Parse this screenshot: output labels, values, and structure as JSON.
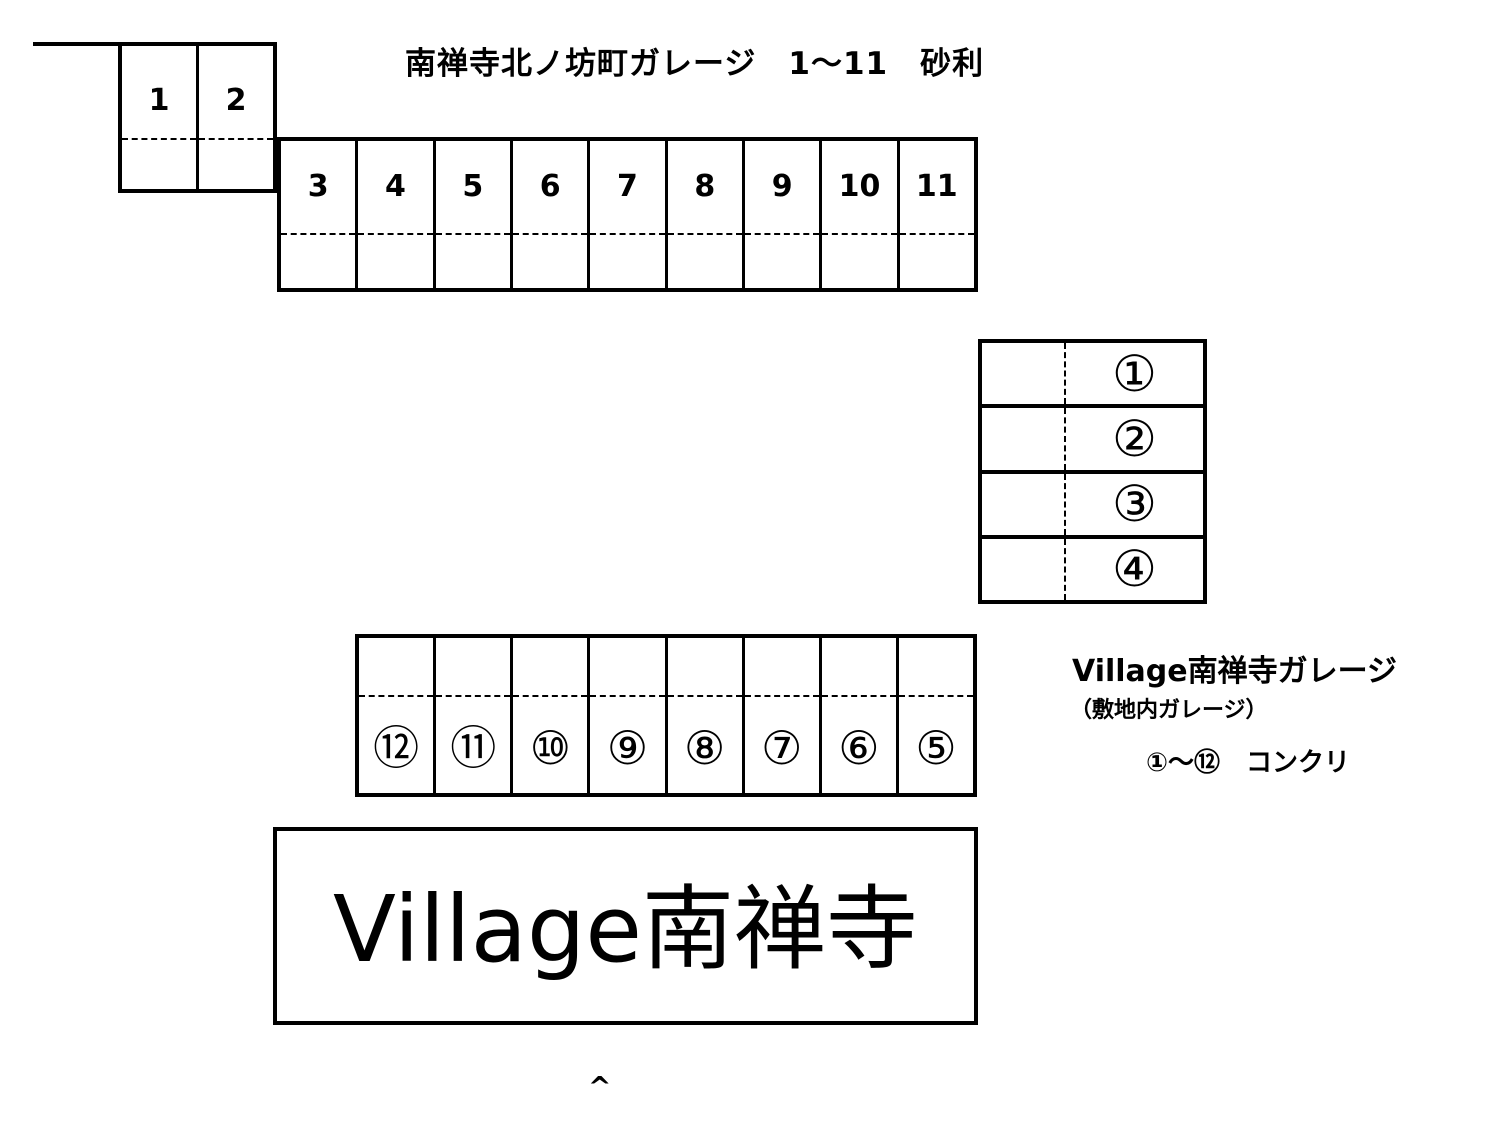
{
  "north_lot": {
    "title": "南禅寺北ノ坊町ガレージ　1～11　砂利",
    "upper_cells": [
      "1",
      "2"
    ],
    "lower_cells": [
      "3",
      "4",
      "5",
      "6",
      "7",
      "8",
      "9",
      "10",
      "11"
    ]
  },
  "village_lot": {
    "side_table_rows": [
      "①",
      "②",
      "③",
      "④"
    ],
    "row_cells": [
      "⑫",
      "⑪",
      "⑩",
      "⑨",
      "⑧",
      "⑦",
      "⑥",
      "⑤"
    ],
    "label_title": "Village南禅寺ガレージ",
    "label_sub": "（敷地内ガレージ）",
    "label_note": "①～⑫　コンクリ",
    "building_sign": "Village南禅寺"
  },
  "misc": {
    "caret": "^"
  },
  "colors": {
    "line": "#000000",
    "background": "#ffffff"
  }
}
